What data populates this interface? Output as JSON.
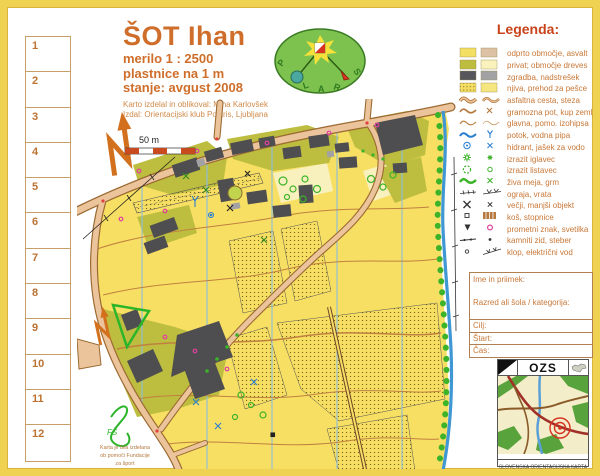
{
  "title_block": {
    "title": "ŠOT Ihan",
    "scale": "merilo  1 : 2500",
    "contour_interval": "plastnice na 1 m",
    "status": "stanje: avgust 2008",
    "credit1": "Karto izdelal in oblikoval: Miha Karlovšek",
    "credit2": "Izdal: Orientacijski klub Polaris, Ljubljana"
  },
  "control_card": {
    "cells": [
      "1",
      "2",
      "3",
      "4",
      "5",
      "6",
      "7",
      "8",
      "9",
      "10",
      "11",
      "12"
    ]
  },
  "club_logo": {
    "letters": [
      "P",
      "L",
      "A",
      "R",
      "S"
    ]
  },
  "legend": {
    "title": "Legenda:",
    "rows": [
      {
        "label": "odprto območje, asvalt"
      },
      {
        "label": "privat; območje dreves"
      },
      {
        "label": "zgradba, nadstrešek"
      },
      {
        "label": "njiva, prehod za pešce"
      },
      {
        "label": "asfaltna cesta, steza"
      },
      {
        "label": "gramozna pot, kup zemlje"
      },
      {
        "label": "glavna, pomo. izohipsa"
      },
      {
        "label": "potok, vodna pipa"
      },
      {
        "label": "hidrant, jašek za vodo"
      },
      {
        "label": "izrazit iglavec"
      },
      {
        "label": "izrazit listavec"
      },
      {
        "label": "živa meja, grm"
      },
      {
        "label": "ograja, vrata"
      },
      {
        "label": "večji, manjši objekt"
      },
      {
        "label": "koš, stopnice"
      },
      {
        "label": "prometni znak, svetilka"
      },
      {
        "label": "kamniti zid, steber"
      },
      {
        "label": "klop, električni vod"
      }
    ]
  },
  "entry_form": {
    "name_label": "Ime in priimek:",
    "category_label": "Razred ali šola / kategorija:",
    "finish_label": "Cilj:",
    "start_label": "Štart:",
    "time_label": "Čas:"
  },
  "ozs_box": {
    "title": "OZS",
    "caption": "SLOVENSKA ORIENTACIJSKA KARTA"
  },
  "map": {
    "scale_label": "50 m",
    "funding_note": [
      "Karta je bila izdelana",
      "ob pomoči Fundacije",
      "za šport"
    ]
  },
  "colors": {
    "accent_text": "#cf6e2a",
    "frame_gold": "#f0d252",
    "open_area_yellow": "#f7df63",
    "private_olive": "#bdbd3f",
    "tree_area_pale": "#faf2bd",
    "building_gray": "#4e4e50",
    "canopy_gray": "#a2a2a4",
    "road_fill_tan": "#ecc49c",
    "road_edge_brown": "#9c6b33",
    "stream_blue": "#3f97d3",
    "vegetation_green": "#3db32a",
    "lamp_magenta": "#e040a0",
    "north_line_blue": "#8cbede"
  }
}
